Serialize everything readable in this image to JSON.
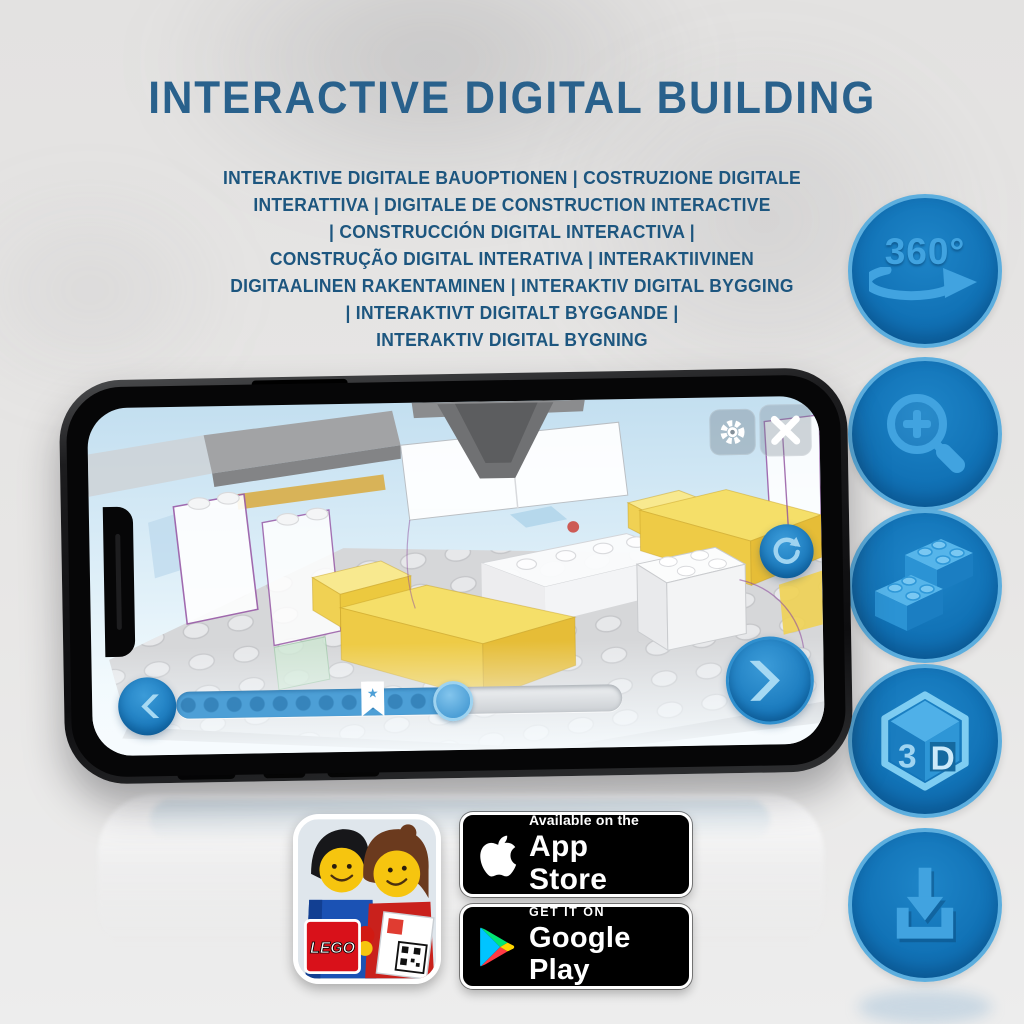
{
  "title": "INTERACTIVE DIGITAL BUILDING",
  "translations": {
    "lines": [
      "INTERAKTIVE DIGITALE BAUOPTIONEN | COSTRUZIONE DIGITALE",
      "INTERATTIVA | DIGITALE DE CONSTRUCTION INTERACTIVE",
      "| CONSTRUCCIÓN DIGITAL INTERACTIVA |",
      "CONSTRUÇÃO DIGITAL INTERATIVA | INTERAKTIIVINEN",
      "DIGITAALINEN RAKENTAMINEN | INTERAKTIV DIGITAL BYGGING",
      "| INTERAKTIVT DIGITALT BYGGANDE |",
      "INTERAKTIV DIGITAL BYGNING"
    ]
  },
  "feature_icons": {
    "rotate_360": {
      "label": "360°"
    },
    "cube_3d": {
      "left": "3",
      "right": "D"
    }
  },
  "phone_app": {
    "slider": {
      "progress_percent": 62,
      "bookmark_percent": 44,
      "bookmark_glyph": "★"
    }
  },
  "store": {
    "app_icon_logo": "LEGO",
    "app_store": {
      "line1": "Available on the",
      "line2": "App Store"
    },
    "google_play": {
      "line1": "GET IT ON",
      "line2": "Google Play"
    }
  },
  "colors": {
    "accent_blue": "#1478bc",
    "icon_glyph_blue": "#41a3e0",
    "title_blue": "#29618c",
    "slider_blue": "#4d9fd6",
    "bed_yellow": "#f3d95e"
  }
}
